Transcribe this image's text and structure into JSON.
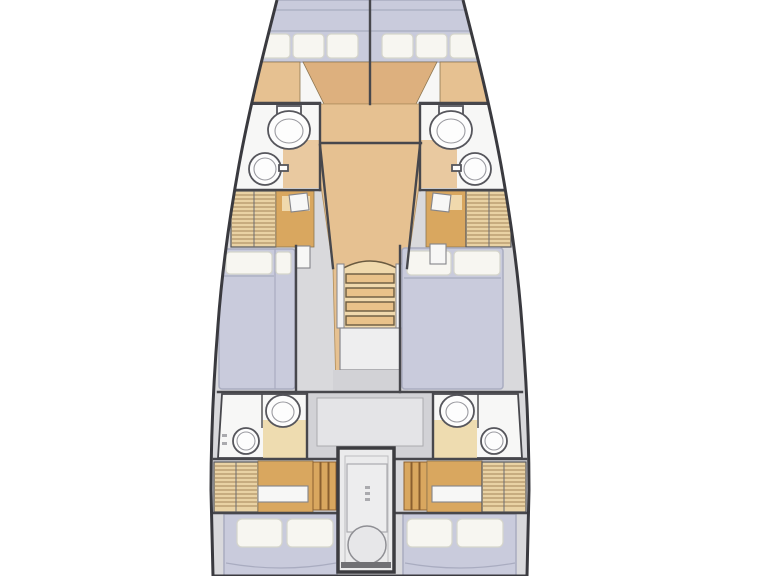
{
  "figure": {
    "kind": "sailboat-interior-floor-plan",
    "orientation": "bow-up"
  },
  "colors": {
    "hull_outline": "#3a3a3f",
    "deck": "#d9d9dc",
    "wall": "#47474c",
    "floor_white": "#f7f7f6",
    "floor_beige": "#eedcb0",
    "wood": "#e6c191",
    "wood_mid": "#ddb07e",
    "wood_dark": "#d9a75f",
    "wood_light": "#f0d9ad",
    "wardrobe": "#e9d2a4",
    "hatch_line": "#a5855a",
    "slat_line": "#8a5f2f",
    "mattress": "#c9cbdc",
    "mattress_line": "#a9acc0",
    "pillow": "#f7f6f1",
    "pillow_line": "#d5d5cb",
    "fixture": "#56565c",
    "fixture_fill": "#fdfdfd",
    "gray_mid": "#d2d2d6",
    "gray_light": "#e4e4e7",
    "engine_fill": "#ebebec"
  },
  "fixtures": {
    "icons": [
      "toilet-icon",
      "sink-icon",
      "stairs-icon",
      "double-berth-icon",
      "pillow-icon",
      "wardrobe-hatch-icon",
      "engine-compartment-icon"
    ],
    "toilets": 4,
    "sinks": 4,
    "berths": 6,
    "companionway_steps": 4
  }
}
